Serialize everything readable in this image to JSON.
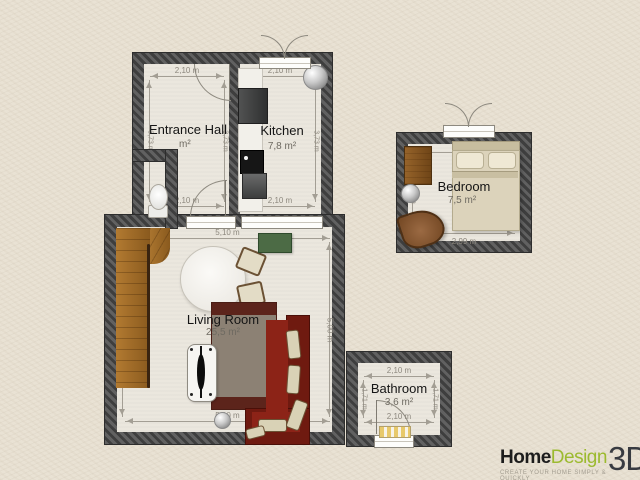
{
  "app": {
    "name": "Home Design 3D floor plan"
  },
  "logo": {
    "home": "Home",
    "design": "Design",
    "suffix": "3D",
    "tagline": "CREATE YOUR HOME SIMPLY & QUICKLY"
  },
  "rooms": {
    "entrance_hall": {
      "name": "Entrance Hall",
      "area": "m²",
      "dim_top": "2,10 m",
      "dim_bottom": "2,10 m",
      "dim_left": "3,73 m",
      "dim_right": "3,73 m"
    },
    "kitchen": {
      "name": "Kitchen",
      "area": "7,8 m²",
      "dim_top": "2,10 m",
      "dim_bottom": "2,10 m",
      "dim_left": "3,73 m",
      "dim_right": "3,73 m"
    },
    "bedroom": {
      "name": "Bedroom",
      "area": "7,5 m²",
      "dim_top": "2,99 m",
      "dim_bottom": "2,99 m",
      "dim_left": "2,55 m",
      "dim_right": "2,55 m"
    },
    "living_room": {
      "name": "Living Room",
      "area": "25,5 m²",
      "dim_top": "5,10 m",
      "dim_bottom": "5,10 m",
      "dim_left": "5,00 m",
      "dim_right": "5,00 m"
    },
    "bathroom": {
      "name": "Bathroom",
      "area": "3,6 m²",
      "dim_top": "2,10 m",
      "dim_bottom": "2,10 m",
      "dim_left": "1,71 m",
      "dim_right": "1,71 m"
    }
  },
  "colors": {
    "wall": "#4a4a4a",
    "floor": "#ebe7de",
    "background": "#e9e2d4",
    "logo_green": "#9cba2f",
    "sofa_red": "#7c2014",
    "wood": "#a06a28",
    "tv_green": "#4c6b45"
  }
}
